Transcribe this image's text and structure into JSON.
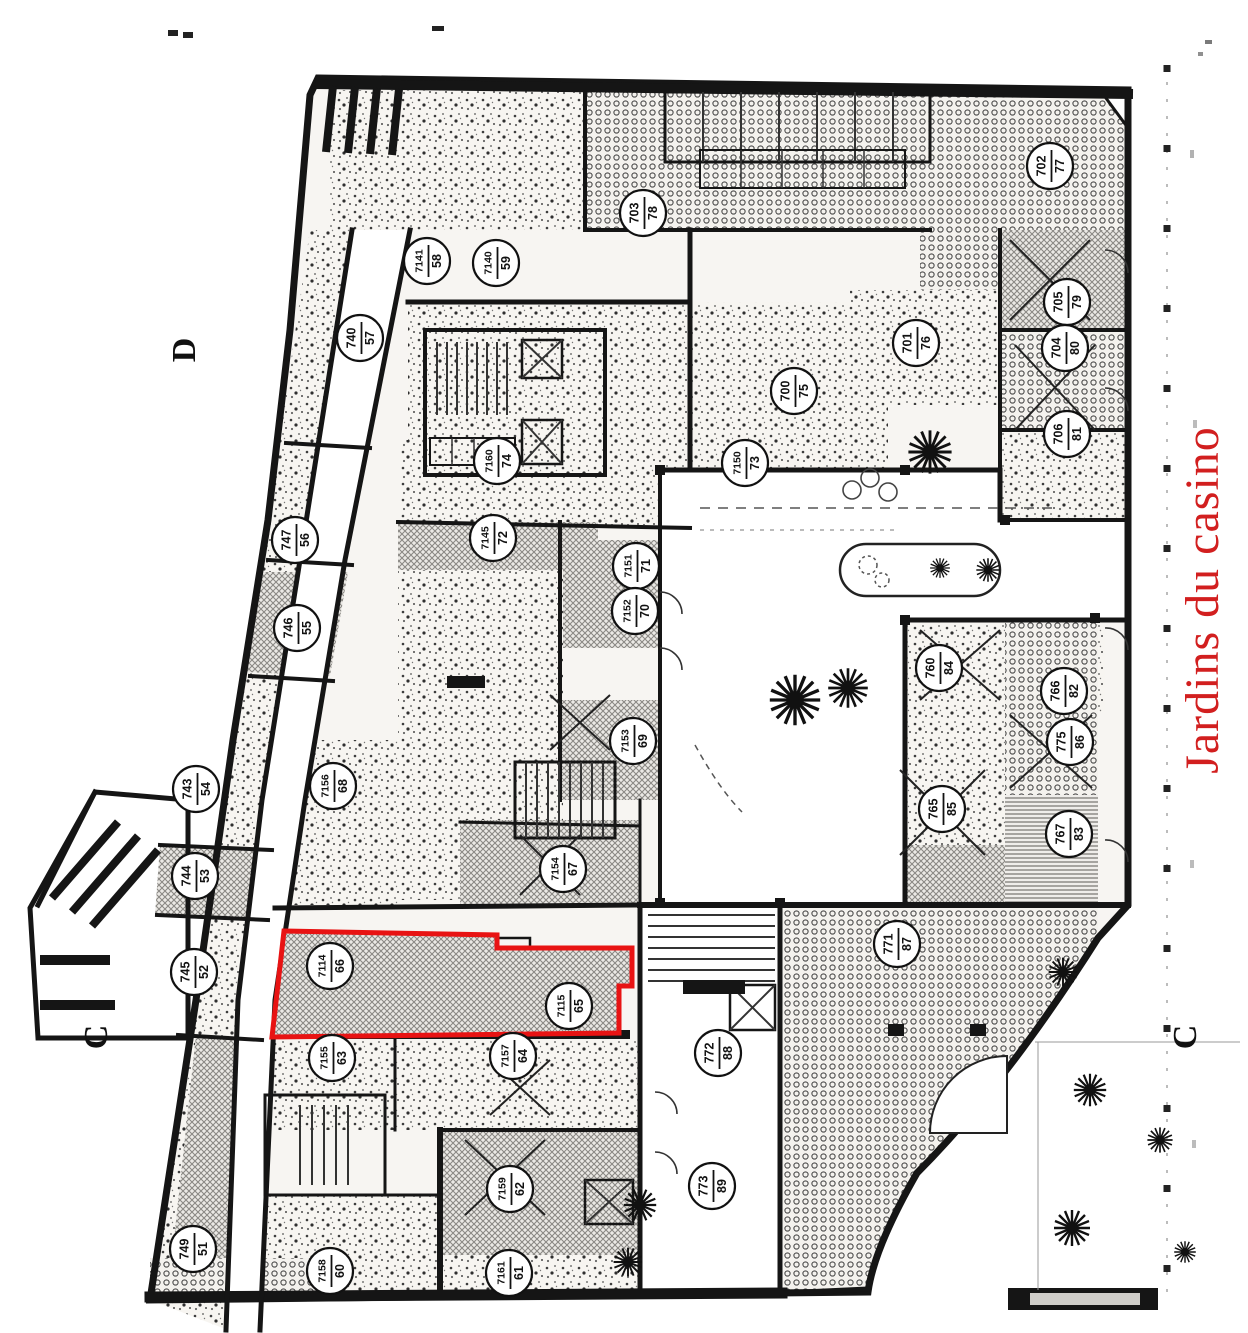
{
  "annotation": {
    "text": "Jardins du casino",
    "color": "#d21f1f"
  },
  "grid_letters": [
    {
      "char": "D"
    },
    {
      "char": "C"
    },
    {
      "char": "C"
    }
  ],
  "highlighted_unit": {
    "outline_color": "#e81313",
    "lots": [
      "7114",
      "7115"
    ],
    "cave_numbers": [
      "66",
      "65"
    ]
  },
  "units": [
    {
      "lot": "740",
      "num": "57",
      "x": 360,
      "y": 338
    },
    {
      "lot": "7141",
      "num": "58",
      "x": 427,
      "y": 261
    },
    {
      "lot": "7140",
      "num": "59",
      "x": 496,
      "y": 263
    },
    {
      "lot": "747",
      "num": "56",
      "x": 295,
      "y": 540
    },
    {
      "lot": "746",
      "num": "55",
      "x": 297,
      "y": 628
    },
    {
      "lot": "743",
      "num": "54",
      "x": 196,
      "y": 789
    },
    {
      "lot": "744",
      "num": "53",
      "x": 195,
      "y": 876
    },
    {
      "lot": "745",
      "num": "52",
      "x": 194,
      "y": 972
    },
    {
      "lot": "749",
      "num": "51",
      "x": 193,
      "y": 1249
    },
    {
      "lot": "7160",
      "num": "74",
      "x": 497,
      "y": 461
    },
    {
      "lot": "7145",
      "num": "72",
      "x": 493,
      "y": 538
    },
    {
      "lot": "7150",
      "num": "73",
      "x": 745,
      "y": 463
    },
    {
      "lot": "7151",
      "num": "71",
      "x": 636,
      "y": 566
    },
    {
      "lot": "7152",
      "num": "70",
      "x": 635,
      "y": 611
    },
    {
      "lot": "7153",
      "num": "69",
      "x": 633,
      "y": 741
    },
    {
      "lot": "7156",
      "num": "68",
      "x": 333,
      "y": 786
    },
    {
      "lot": "7154",
      "num": "67",
      "x": 563,
      "y": 869
    },
    {
      "lot": "7114",
      "num": "66",
      "x": 330,
      "y": 966
    },
    {
      "lot": "7115",
      "num": "65",
      "x": 569,
      "y": 1006
    },
    {
      "lot": "7155",
      "num": "63",
      "x": 332,
      "y": 1058
    },
    {
      "lot": "7157",
      "num": "64",
      "x": 513,
      "y": 1056
    },
    {
      "lot": "7159",
      "num": "62",
      "x": 510,
      "y": 1189
    },
    {
      "lot": "7158",
      "num": "60",
      "x": 330,
      "y": 1271
    },
    {
      "lot": "7161",
      "num": "61",
      "x": 509,
      "y": 1273
    },
    {
      "lot": "703",
      "num": "78",
      "x": 643,
      "y": 213
    },
    {
      "lot": "702",
      "num": "77",
      "x": 1050,
      "y": 166
    },
    {
      "lot": "705",
      "num": "79",
      "x": 1067,
      "y": 302
    },
    {
      "lot": "704",
      "num": "80",
      "x": 1065,
      "y": 348
    },
    {
      "lot": "706",
      "num": "81",
      "x": 1067,
      "y": 434
    },
    {
      "lot": "701",
      "num": "76",
      "x": 916,
      "y": 343
    },
    {
      "lot": "700",
      "num": "75",
      "x": 794,
      "y": 391
    },
    {
      "lot": "760",
      "num": "84",
      "x": 939,
      "y": 668
    },
    {
      "lot": "766",
      "num": "82",
      "x": 1064,
      "y": 691
    },
    {
      "lot": "775",
      "num": "86",
      "x": 1070,
      "y": 742
    },
    {
      "lot": "765",
      "num": "85",
      "x": 942,
      "y": 809
    },
    {
      "lot": "767",
      "num": "83",
      "x": 1069,
      "y": 834
    },
    {
      "lot": "771",
      "num": "87",
      "x": 897,
      "y": 944
    },
    {
      "lot": "772",
      "num": "88",
      "x": 718,
      "y": 1053
    },
    {
      "lot": "773",
      "num": "89",
      "x": 712,
      "y": 1186
    }
  ]
}
